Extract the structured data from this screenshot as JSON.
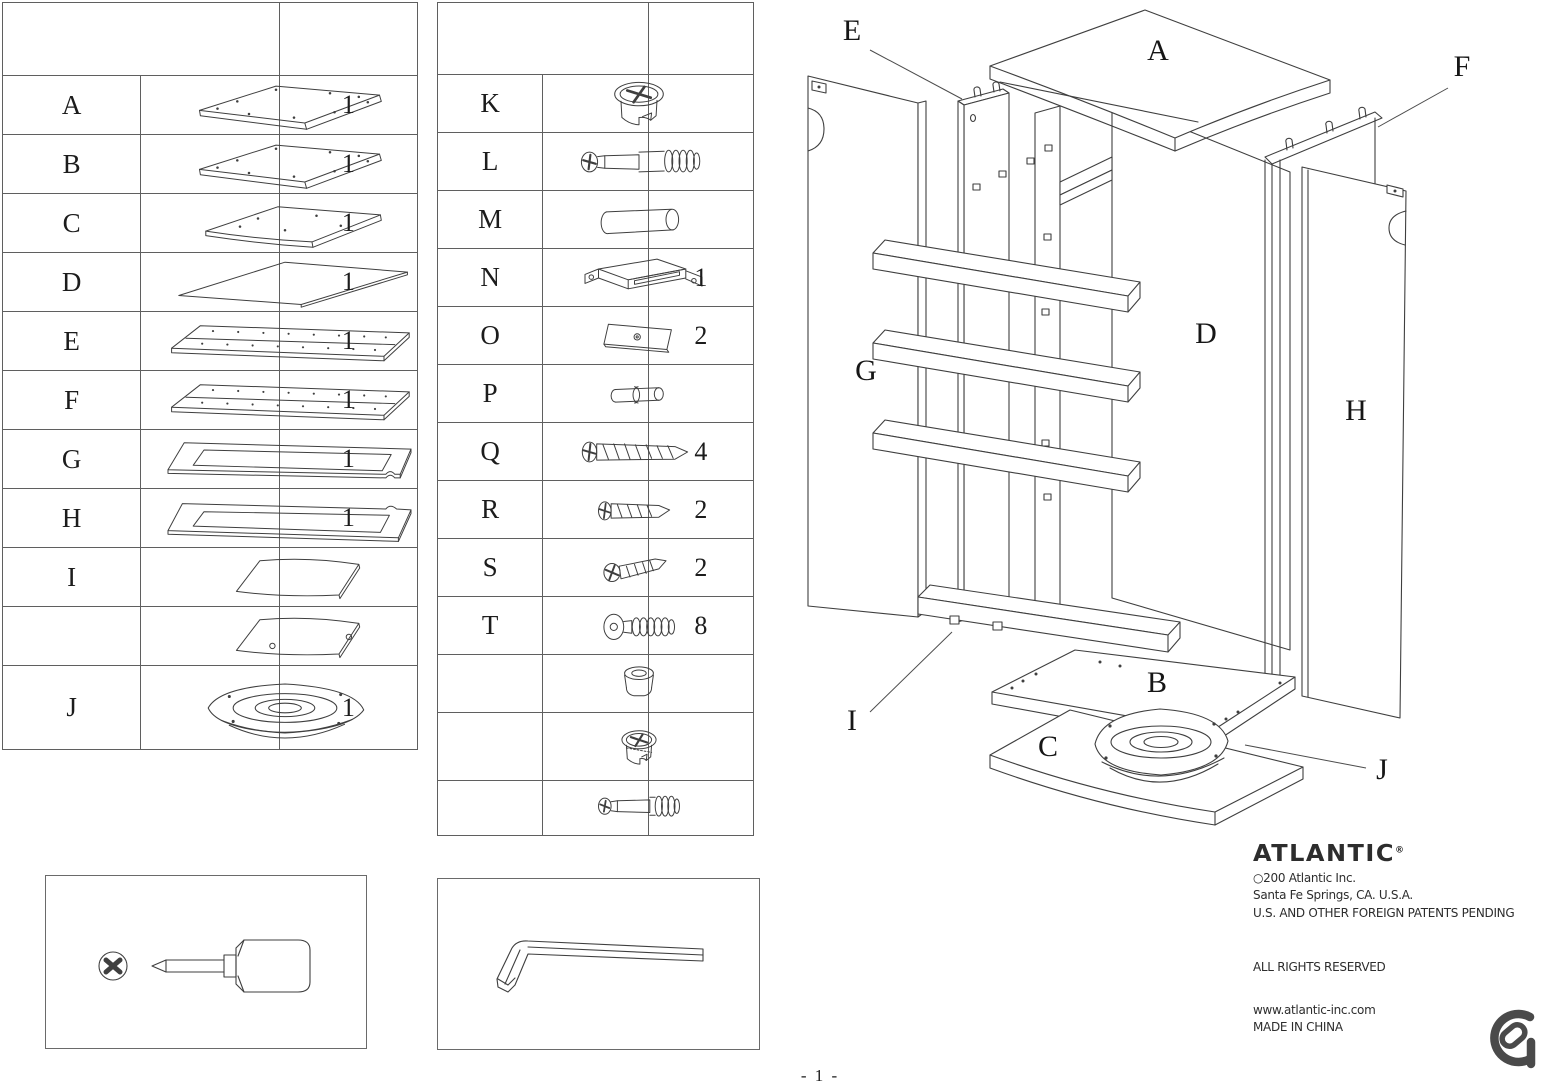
{
  "page": {
    "number": "- 1 -"
  },
  "parts_table": {
    "rows": [
      {
        "id": "A",
        "qty": "1",
        "icon": "panel-top"
      },
      {
        "id": "B",
        "qty": "1",
        "icon": "panel-top"
      },
      {
        "id": "C",
        "qty": "1",
        "icon": "panel-curved"
      },
      {
        "id": "D",
        "qty": "1",
        "icon": "panel-back"
      },
      {
        "id": "E",
        "qty": "1",
        "icon": "panel-plank"
      },
      {
        "id": "F",
        "qty": "1",
        "icon": "panel-plank"
      },
      {
        "id": "G",
        "qty": "1",
        "icon": "door-frame"
      },
      {
        "id": "H",
        "qty": "1",
        "icon": "door-frame-2"
      },
      {
        "id": "I",
        "qty": "",
        "icon": "panel-small"
      },
      {
        "id": "",
        "qty": "",
        "icon": "panel-small-holes"
      },
      {
        "id": "J",
        "qty": "1",
        "icon": "swivel"
      }
    ]
  },
  "hardware_table": {
    "rows": [
      {
        "id": "K",
        "qty": "",
        "icon": "cam-lock"
      },
      {
        "id": "L",
        "qty": "",
        "icon": "cam-bolt"
      },
      {
        "id": "M",
        "qty": "",
        "icon": "dowel"
      },
      {
        "id": "N",
        "qty": "1",
        "icon": "catch"
      },
      {
        "id": "O",
        "qty": "2",
        "icon": "plate"
      },
      {
        "id": "P",
        "qty": "",
        "icon": "pin"
      },
      {
        "id": "Q",
        "qty": "4",
        "icon": "screw-long"
      },
      {
        "id": "R",
        "qty": "2",
        "icon": "screw-medium"
      },
      {
        "id": "S",
        "qty": "2",
        "icon": "screw-small"
      },
      {
        "id": "T",
        "qty": "8",
        "icon": "bolt-flat"
      },
      {
        "id": "",
        "qty": "",
        "icon": "cap"
      },
      {
        "id": "",
        "qty": "",
        "icon": "cam-lock-sm"
      },
      {
        "id": "",
        "qty": "",
        "icon": "cam-bolt-sm"
      }
    ]
  },
  "diagram": {
    "labels": [
      {
        "text": "E",
        "x": 62,
        "y": 40,
        "leader": [
          80,
          50,
          172,
          99
        ]
      },
      {
        "text": "A",
        "x": 368,
        "y": 60
      },
      {
        "text": "F",
        "x": 672,
        "y": 76,
        "leader": [
          658,
          88,
          588,
          127
        ]
      },
      {
        "text": "G",
        "x": 76,
        "y": 380
      },
      {
        "text": "D",
        "x": 416,
        "y": 343
      },
      {
        "text": "H",
        "x": 566,
        "y": 420
      },
      {
        "text": "I",
        "x": 62,
        "y": 730,
        "leader": [
          80,
          712,
          162,
          632
        ]
      },
      {
        "text": "B",
        "x": 367,
        "y": 692
      },
      {
        "text": "C",
        "x": 258,
        "y": 756
      },
      {
        "text": "J",
        "x": 592,
        "y": 779,
        "leader": [
          576,
          768,
          455,
          745
        ]
      }
    ]
  },
  "branding": {
    "logo_text": "ATLANTIC",
    "registered_mark": "®",
    "copyright_line": "○200   Atlantic Inc.",
    "address_line": "Santa Fe Springs, CA. U.S.A.",
    "patents_line": "U.S. AND OTHER FOREIGN PATENTS PENDING",
    "rights_line": "ALL RIGHTS RESERVED",
    "website": "www.atlantic-inc.com",
    "origin_line": "MADE IN CHINA"
  }
}
